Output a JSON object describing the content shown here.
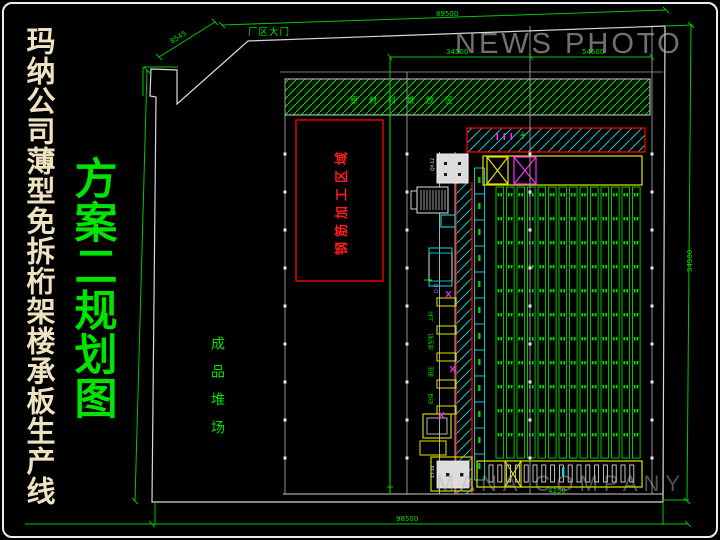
{
  "title": {
    "text": "玛纳公司薄型免拆桁架楼承板生产线",
    "color": "#efe2c0"
  },
  "subtitle": {
    "text": "方案二规划图",
    "color": "#00e400"
  },
  "watermark_top": "NEWS PHOTO",
  "watermark_bottom": "MANA COMPANY",
  "plan": {
    "gate_label": "厂区大门",
    "material_band_label": "原材料堆放区",
    "rebar_area_label": "钢筋加工区域",
    "yard_label": "成品堆场",
    "section_label": "D-D"
  },
  "dimensions": {
    "top": "89500",
    "bottom": "98500",
    "right": "54500",
    "gate": "8545",
    "bay_left": "34500",
    "bay_right": "54500",
    "stall": "4250"
  },
  "line_labels": [
    "上料",
    "成型机",
    "辊压",
    "码垛"
  ],
  "machine_tags": {
    "m1": "QY-12",
    "m6": "4T-14"
  },
  "colors": {
    "green": "#00e400",
    "red": "#e60000",
    "cyan": "#00dcdc",
    "yellow": "#e6e600",
    "magenta": "#ff2bff",
    "boundary": "#d9d9d9",
    "grid": "#9f9f9f",
    "title_cream": "#efe2c0",
    "watermark_gray": "#b5b5b5"
  },
  "generated": {
    "racks": {
      "count": 14,
      "x0": 496,
      "pitch": 10.5,
      "width": 7.6,
      "y": 187,
      "height": 271,
      "rows": 11,
      "row_pitch": 24
    },
    "cyan_rack": {
      "x": 474.5,
      "width": 10,
      "y0": 168,
      "seg": 26,
      "count": 12
    },
    "stalls": {
      "count": 17,
      "x0": 489,
      "pitch": 8.8,
      "width": 4,
      "y": 465,
      "height": 17
    },
    "grid_ticks": {
      "xs": [
        285,
        407,
        530,
        652
      ],
      "y0": 154,
      "pitch": 38,
      "count": 9
    },
    "stations": {
      "ys": [
        298,
        326,
        353,
        380,
        406
      ],
      "x": 437,
      "width": 19,
      "height": 8
    },
    "line_label_pos": {
      "x": 433,
      "ys": [
        322,
        350,
        377,
        404
      ]
    }
  }
}
